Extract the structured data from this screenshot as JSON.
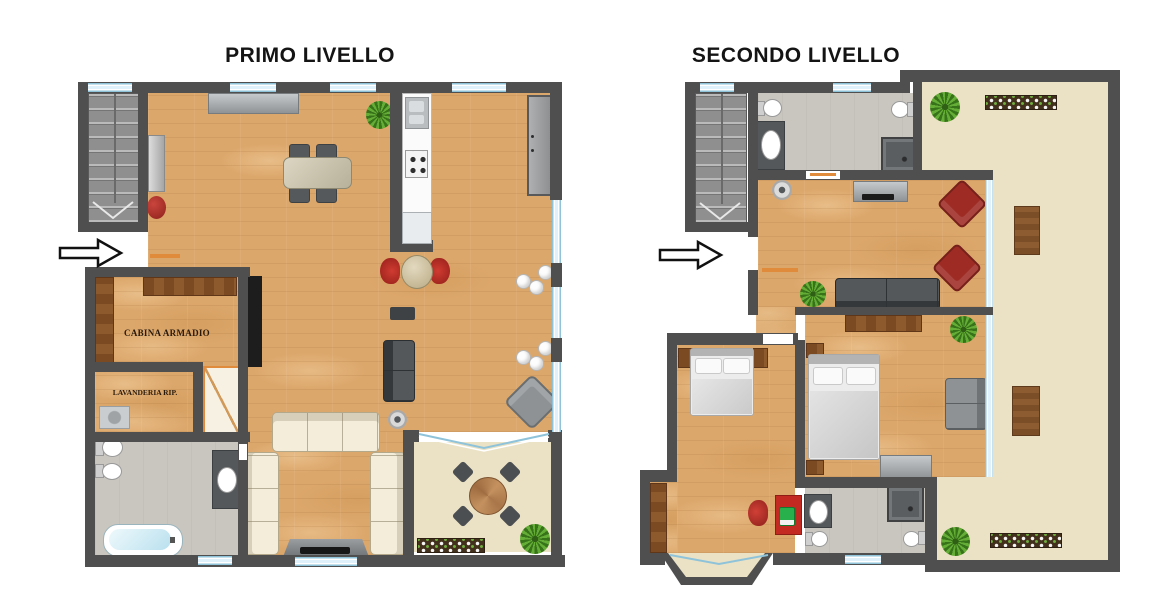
{
  "page": {
    "background": "#ffffff"
  },
  "plans": {
    "first": {
      "title": "PRIMO LIVELLO"
    },
    "second": {
      "title": "SECONDO LIVELLO"
    }
  },
  "room_labels": {
    "cabina_armadio": "CABINA ARMADIO",
    "lavanderia": "LAVANDERIA RIP."
  },
  "icons": {
    "entrance_arrow": "right-arrow",
    "stairs_direction": "chevron-down"
  },
  "colors": {
    "wall": "#4f4f4f",
    "wood": "#dca76b",
    "terrace": "#ebe2c5",
    "bath_floor": "#c9c6bf",
    "stairs": "#8f8f8f",
    "glass": "#dff2fb",
    "glass_border": "#8fc3da",
    "sofa_cream": "#f3edda",
    "dark_furn": "#4a4d4f",
    "red": "#b2322c",
    "brown": "#85552b",
    "brown_dark": "#5f3618",
    "green": "#4a8a28",
    "bed_white": "#ececec",
    "orange": "#e08a3c",
    "black_panel": "#1d1d1d",
    "cabinet_gray": "#9c9ea0",
    "label_color": "#2a1a0c"
  }
}
